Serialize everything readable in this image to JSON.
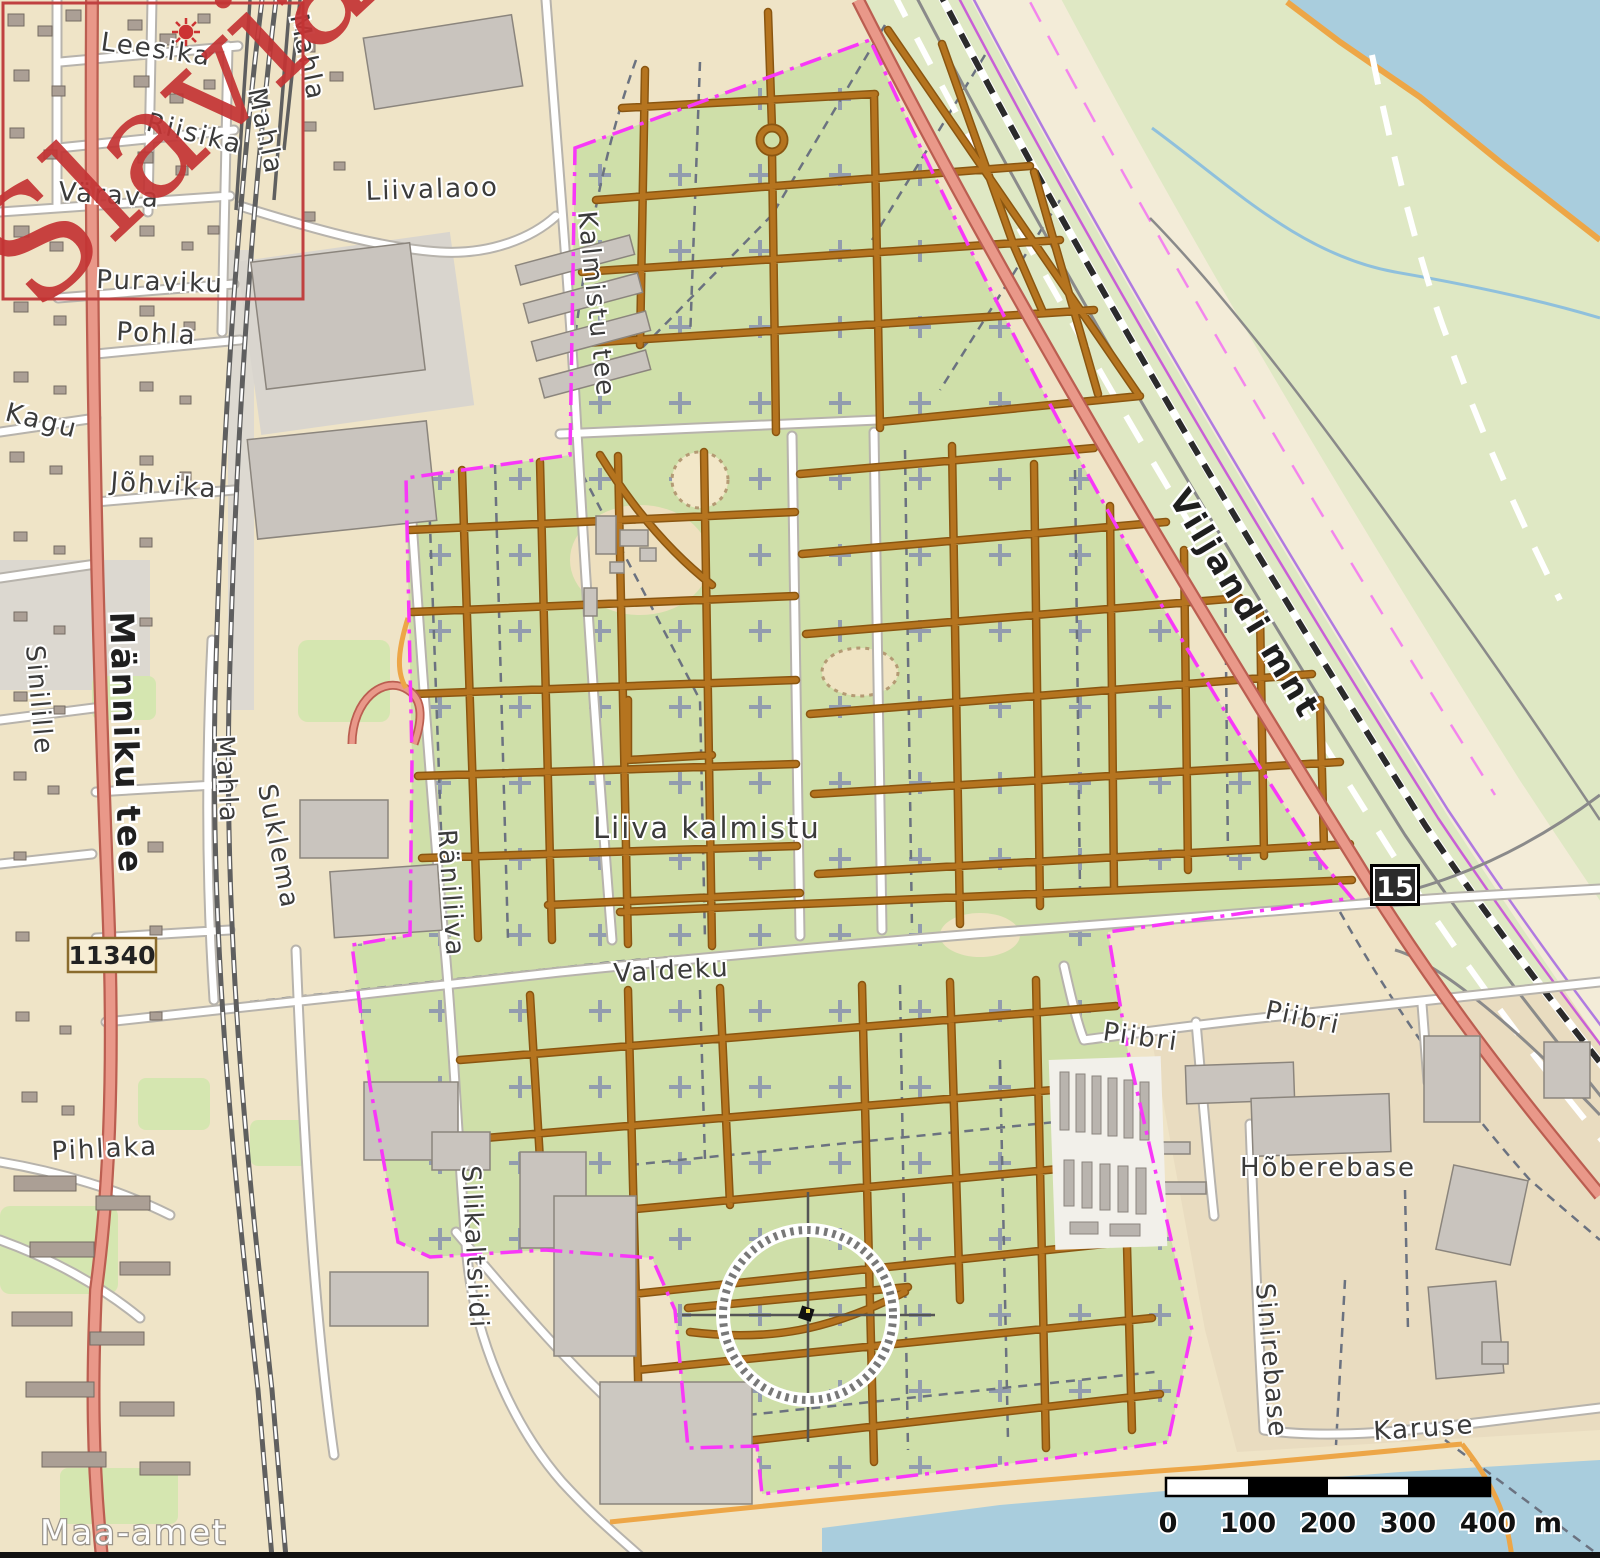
{
  "map": {
    "title": "Liiva kalmistu area map",
    "watermark": {
      "text": "Slavia"
    },
    "attribution": {
      "text": "Maa-amet"
    },
    "badges": {
      "road_11340": {
        "text": "11340"
      },
      "road_15": {
        "text": "15"
      }
    },
    "scale_bar": {
      "ticks": [
        "0",
        "100",
        "200",
        "300",
        "400"
      ],
      "unit": "m"
    },
    "labels": [
      {
        "id": "leesika",
        "text": "Leesika",
        "kind": "street"
      },
      {
        "id": "riisika",
        "text": "Riisika",
        "kind": "street"
      },
      {
        "id": "varava",
        "text": "Värava",
        "kind": "street"
      },
      {
        "id": "puraviku",
        "text": "Puraviku",
        "kind": "street"
      },
      {
        "id": "pohla",
        "text": "Pohla",
        "kind": "street"
      },
      {
        "id": "kagu",
        "text": "Kagu",
        "kind": "street"
      },
      {
        "id": "johvika",
        "text": "Jõhvika",
        "kind": "street"
      },
      {
        "id": "manniku-tee",
        "text": "Männiku tee",
        "kind": "major-road"
      },
      {
        "id": "sinilille",
        "text": "Sinilille",
        "kind": "street"
      },
      {
        "id": "mahla-south",
        "text": "Mahla",
        "kind": "street"
      },
      {
        "id": "suklema",
        "text": "Suklema",
        "kind": "street"
      },
      {
        "id": "mahla-north-1",
        "text": "Mahla",
        "kind": "street"
      },
      {
        "id": "mahla-north-2",
        "text": "Mahla",
        "kind": "street"
      },
      {
        "id": "pihlaka",
        "text": "Pihlaka",
        "kind": "street"
      },
      {
        "id": "liivalaoo",
        "text": "Liivalaoo",
        "kind": "street"
      },
      {
        "id": "kalmistu-tee",
        "text": "Kalmistu tee",
        "kind": "street"
      },
      {
        "id": "raniliiva",
        "text": "Räniliiva",
        "kind": "street"
      },
      {
        "id": "silikaltsiidi",
        "text": "Silikaltsiidi",
        "kind": "street"
      },
      {
        "id": "liiva-kalmistu",
        "text": "Liiva kalmistu",
        "kind": "place"
      },
      {
        "id": "valdeku",
        "text": "Valdeku",
        "kind": "street"
      },
      {
        "id": "viljandi-mnt",
        "text": "Viljandi mnt",
        "kind": "major-road"
      },
      {
        "id": "piibri-west",
        "text": "Piibri",
        "kind": "street"
      },
      {
        "id": "piibri-east",
        "text": "Piibri",
        "kind": "street"
      },
      {
        "id": "hoberebase",
        "text": "Hõberebase",
        "kind": "street"
      },
      {
        "id": "sinirebase",
        "text": "Sinirebase",
        "kind": "street"
      },
      {
        "id": "karuse",
        "text": "Karuse",
        "kind": "street"
      }
    ],
    "colors": {
      "residential": "#efe4c7",
      "field_green": "#dfe8c4",
      "cemetery_green": "#cfdfa9",
      "park_green": "#d5e6b0",
      "water": "#a9cddd",
      "road_major": "#e99889",
      "road_major_casing": "#bb5e51",
      "cemetery_path": "#b5741f",
      "boundary_magenta": "#f838f8",
      "railway": "#5f5f5f",
      "watermark_red": "#c43434"
    }
  }
}
